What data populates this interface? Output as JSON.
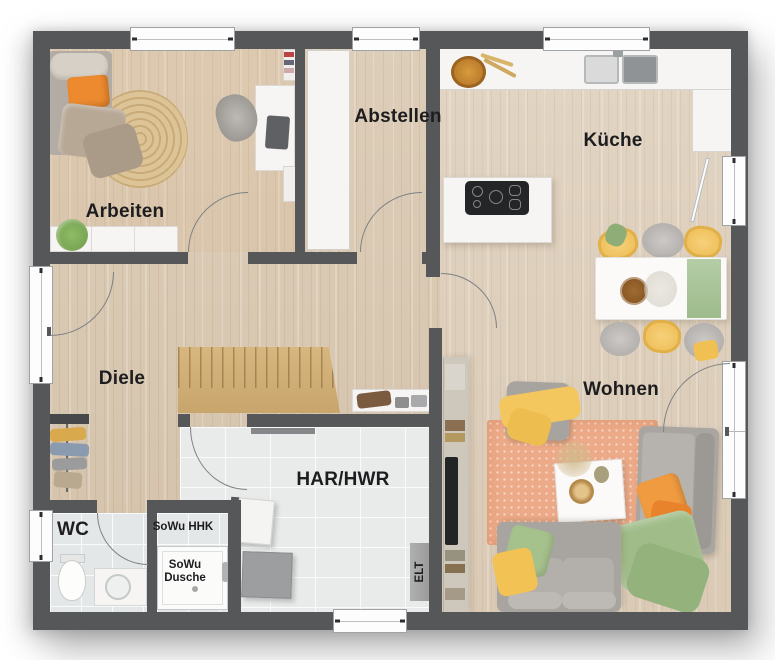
{
  "rooms": {
    "arbeiten": "Arbeiten",
    "abstellen": "Abstellen",
    "kueche": "Küche",
    "wohnen": "Wohnen",
    "diele": "Diele",
    "har": "HAR/HWR",
    "wc": "WC"
  },
  "annotations": {
    "sowu_hhk": "SoWu HHK",
    "sowu_line1": "SoWu",
    "sowu_line2": "Dusche",
    "elt": "ELT"
  },
  "palette": {
    "wall": "#565759",
    "wood_floor": "#d9c8b1",
    "tile_floor": "#e9ebeb",
    "living_rug": "#edaa88",
    "sofa_grey": "#a9a5a1",
    "accent_yellow": "#f2c45c",
    "accent_orange": "#ee9038",
    "accent_green": "#a2bf8b",
    "counter_white": "#f6f5f3",
    "stair_wood": "#d2b077",
    "jute_rug": "#d8bf92"
  }
}
